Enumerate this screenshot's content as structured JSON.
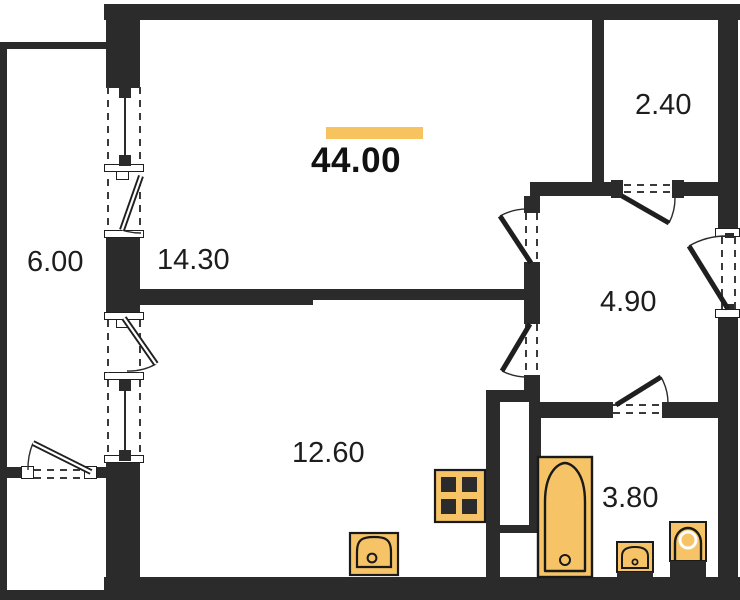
{
  "plan": {
    "total_area": "44.00",
    "rooms": {
      "living": "14.30",
      "kitchen": "12.60",
      "hallway": "4.90",
      "bathroom": "3.80",
      "balcony_left": "6.00",
      "balcony_top": "2.40"
    },
    "colors": {
      "accent": "#F6C35F",
      "wall": "#2B2B2C",
      "fixture_fill": "#F6C466"
    },
    "fixtures": [
      "bathtub",
      "toilet",
      "bathroom-sink",
      "kitchen-sink",
      "stove"
    ]
  }
}
